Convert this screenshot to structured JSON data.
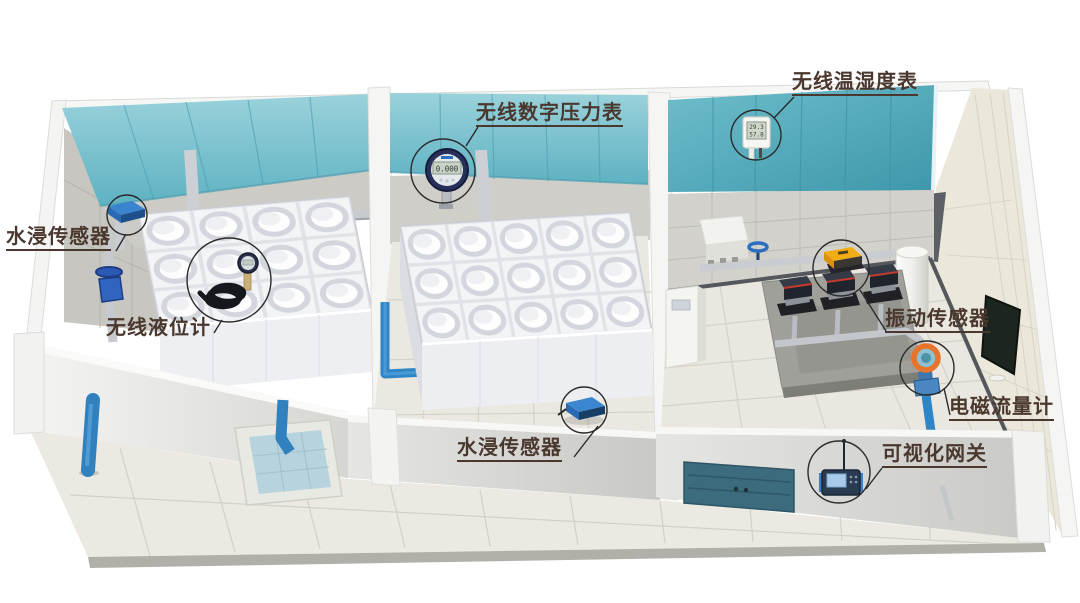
{
  "callouts": {
    "water_sensor_left": {
      "label": "水浸传感器"
    },
    "level_gauge": {
      "label": "无线液位计"
    },
    "pressure_gauge": {
      "label": "无线数字压力表"
    },
    "temp_humidity": {
      "label": "无线温湿度表"
    },
    "vibration_sensor": {
      "label": "振动传感器"
    },
    "flow_meter": {
      "label": "电磁流量计"
    },
    "water_sensor_floor": {
      "label": "水浸传感器"
    },
    "gateway": {
      "label": "可视化网关"
    }
  },
  "device_readings": {
    "pressure_display": "0.000",
    "temperature_display": "29.3",
    "humidity_display": "57.8"
  },
  "colors": {
    "label_text": "#4a382e",
    "ceiling_teal": "#76c2cf",
    "ceiling_teal_deep": "#4fa8ba",
    "pipe_blue": "#2f86c6",
    "flow_meter_orange": "#e8732a",
    "vibration_yellow": "#f3ad14",
    "door_teal": "#3c6b7d"
  }
}
